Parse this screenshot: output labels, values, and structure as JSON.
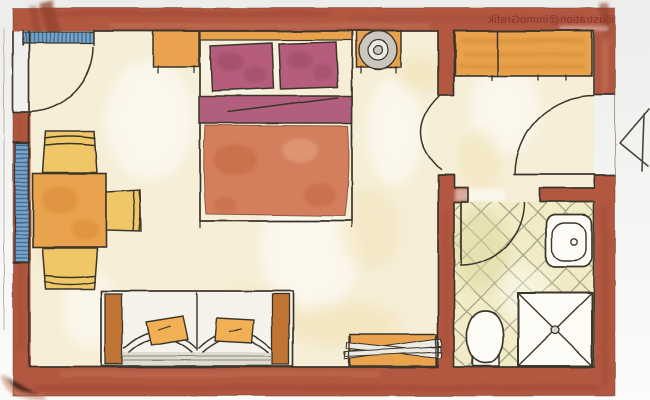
{
  "meta": {
    "kind": "hand-drawn watercolor floor plan illustration"
  },
  "watermark": {
    "text": "illustration@immoGrafik",
    "mirrored": true
  },
  "rooms": {
    "main_room": {
      "furniture": [
        "double-bed",
        "pillow-left",
        "pillow-right",
        "blanket",
        "duvet",
        "headboard",
        "nightstand-left",
        "nightstand-right",
        "table-lamp",
        "dining-table",
        "chair-top",
        "chair-right",
        "chair-bottom",
        "sofa",
        "sofa-cushion-left",
        "sofa-cushion-right",
        "luggage-bench"
      ]
    },
    "hallway": {
      "furniture": [
        "wardrobe"
      ],
      "doors": [
        "entry-door",
        "room-door"
      ]
    },
    "bathroom": {
      "fixtures": [
        "washbasin",
        "toilet",
        "shower"
      ],
      "floor": "diagonal-tiles",
      "door": "bathroom-door"
    }
  },
  "openings": {
    "windows": [
      "window-left-wall",
      "balcony-window-top-left"
    ],
    "entrance_marker": "entrance-arrow"
  },
  "colors": {
    "background_top": "#ededeb",
    "background": "#fbfbf9",
    "wall": "#b25841",
    "wall_dark": "#93412c",
    "wall_light": "#cf8a6d",
    "line": "#3b352c",
    "floor": "#f6eed7",
    "floor_patch": "#efdfae",
    "furn_orange": "#e9a24d",
    "furn_orange_dark": "#d4882f",
    "chair_yellow": "#efc766",
    "pillow": "#b65d7e",
    "pillow_dark": "#9c4763",
    "blanket": "#b25f7f",
    "duvet": "#d37f5d",
    "duvet_dark": "#c2663f",
    "sofa_body": "#f4f2ea",
    "sofa_base": "#d8d4c8",
    "armrest": "#c07436",
    "cushion": "#f0b052",
    "lamp": "#cbc7bf",
    "window_blue": "#7ca3c6",
    "window_blue_dark": "#3e6f98",
    "tile": "#f1ecc6",
    "tile_line": "#8f8d79",
    "tile_shade": "#ddd69c",
    "fixture": "#fcfbf5",
    "watermark": "#7c3227",
    "arrow": "#4a4539"
  }
}
